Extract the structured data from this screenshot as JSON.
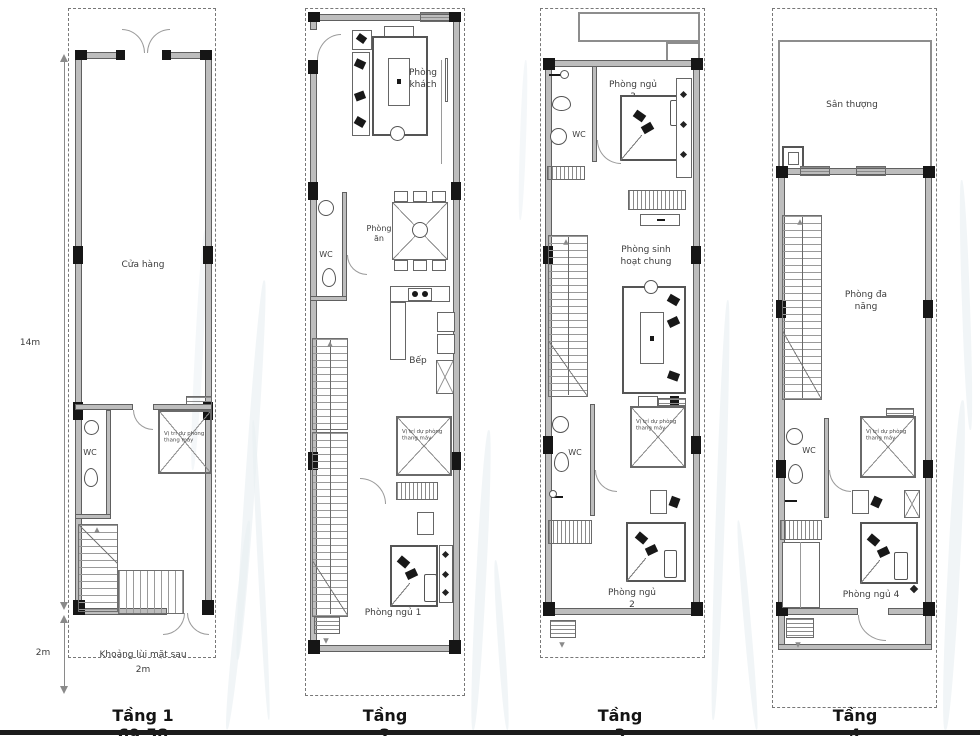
{
  "plans": {
    "t1": {
      "caption": "Tầng 1 69.58",
      "shop": "Cửa hàng",
      "wc": "WC",
      "elevator": "Vị trí dự phòng thang máy",
      "setback_line1": "Khoảng lùi mặt sau",
      "setback_line2": "2m",
      "dim_main": "14m",
      "dim_setback": "2m"
    },
    "t2": {
      "caption": "Tầng 2",
      "living": "Phòng khách",
      "dining": "Phòng ăn",
      "kitchen": "Bếp",
      "wc": "WC",
      "elevator": "Vị trí dự phòng thang máy",
      "bedroom": "Phòng ngủ 1"
    },
    "t3": {
      "caption": "Tầng 3",
      "bedroom_top": "Phòng ngủ 3",
      "wc_top": "WC",
      "family_room": "Phòng sinh hoạt chung",
      "wc_bottom": "WC",
      "elevator": "Vị trí dự phòng thang máy",
      "bedroom": "Phòng ngủ 2"
    },
    "t4": {
      "caption": "Tầng 4",
      "terrace": "Sân thượng",
      "multi_room": "Phòng đa năng",
      "wc": "WC",
      "elevator": "Vị trí dự phòng thang máy",
      "bedroom": "Phòng ngủ 4"
    }
  }
}
